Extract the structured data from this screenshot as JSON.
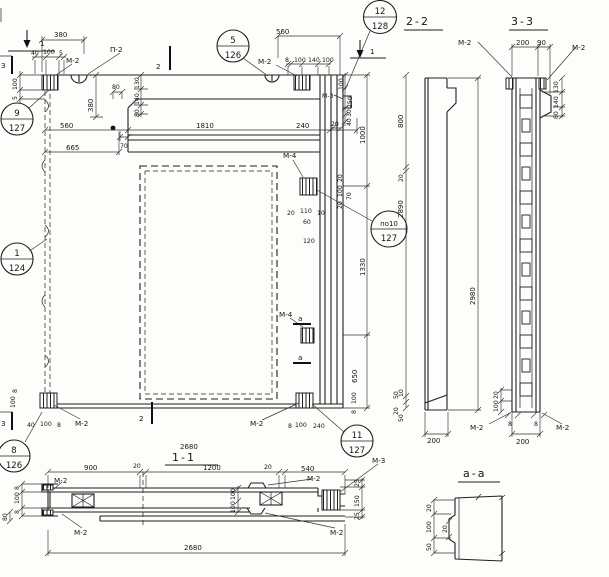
{
  "colors": {
    "ink": "#1f1f1f",
    "paper": "#fdfdfb"
  },
  "titles": {
    "s22": "2-2",
    "s33": "3-3",
    "s11": "1-1",
    "saa": "а-а"
  },
  "labels": {
    "m2": "М-2",
    "m3": "М-3",
    "m4": "М-4",
    "p2": "П-2"
  },
  "cuts": {
    "c1": "1",
    "c2": "2",
    "c3": "3",
    "ca": "а"
  },
  "callouts": [
    {
      "num": "9",
      "sheet": "127"
    },
    {
      "num": "5",
      "sheet": "126"
    },
    {
      "num": "12",
      "sheet": "128"
    },
    {
      "num": "1",
      "sheet": "124"
    },
    {
      "num": "по10",
      "sheet": "127"
    },
    {
      "num": "8",
      "sheet": "126"
    },
    {
      "num": "11",
      "sheet": "127"
    }
  ],
  "dims": {
    "t380": "380",
    "t40": "40",
    "t100a": "100",
    "t5a": "5",
    "l100": "100",
    "l5": "5",
    "t560l": "560",
    "t70": "70",
    "t665": "665",
    "t380v": "380",
    "t80beam": "80",
    "stk130": "130",
    "stk140": "140",
    "stk80": "80",
    "t1810": "1810",
    "t240": "240",
    "tm560": "560",
    "tm8": "8",
    "tm100a": "100",
    "tm140": "140",
    "tm100b": "100",
    "rc100": "100",
    "rc250": "250",
    "rc30": "30",
    "rc40": "40",
    "rc20": "20",
    "rv1000": "1000",
    "rv1330": "1330",
    "rv650": "650",
    "rv2890": "2890",
    "s22_800": "800",
    "s22_20": "20",
    "s22_10": "10",
    "s22_50": "50",
    "s22_2980": "2980",
    "s22_200": "200",
    "m4_20": "20",
    "m4_110": "110",
    "m4_10": "10",
    "m4_60": "60",
    "m4_120": "120",
    "m4v20a": "20",
    "m4v100": "100",
    "m4v20b": "20",
    "m4_70": "70",
    "bl8": "8",
    "bl100": "100",
    "blc40": "40",
    "blc100": "100",
    "blc8": "8",
    "b2680": "2680",
    "br8": "8",
    "br100": "100",
    "br240": "240",
    "brv100": "100",
    "brv8": "8",
    "brv50": "50",
    "brv20": "20",
    "s33_200": "200",
    "s33_90": "90",
    "s33_130": "130",
    "s33_140": "140",
    "s33_80": "80",
    "s33_8l": "8",
    "s33_8r": "8",
    "s33_200b": "200",
    "s33_20": "20",
    "s33_100": "100",
    "s11_900": "900",
    "s11_20a": "20",
    "s11_1200": "1200",
    "s11_20b": "20",
    "s11_540": "540",
    "s11_8a": "8",
    "s11_100l": "100",
    "s11_8b": "8",
    "s11_80": "80",
    "s11_100m1": "100",
    "s11_100m2": "100",
    "s11_25a": "25",
    "s11_150": "150",
    "s11_25b": "25",
    "s11_2680": "2680",
    "aa_20a": "20",
    "aa_100": "100",
    "aa_50": "50",
    "aa_20b": "20"
  }
}
